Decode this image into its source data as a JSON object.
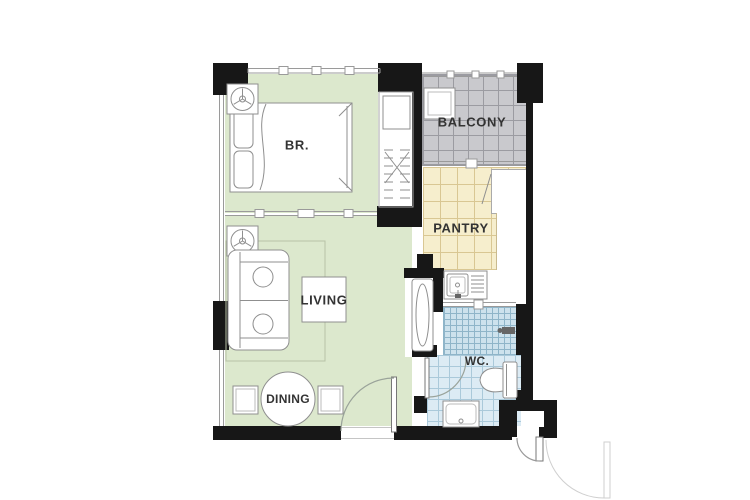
{
  "plan_title": "one-bedroom unit floor plan",
  "rooms": {
    "bedroom": {
      "label": "BR."
    },
    "balcony": {
      "label": "BALCONY"
    },
    "pantry": {
      "label": "PANTRY"
    },
    "living": {
      "label": "LIVING"
    },
    "dining": {
      "label": "DINING"
    },
    "wc": {
      "label": "WC."
    }
  },
  "colors": {
    "wall": "#171717",
    "bedroom_floor": "#dce8cd",
    "balcony_floor": "#c9c9cd",
    "balcony_grid": "#9b9ba1",
    "pantry_floor": "#f6eecd",
    "pantry_grid": "#d9c793",
    "shower_floor": "#cde2ed",
    "shower_grid": "#8fb5c9",
    "wc_floor": "#dcebf4",
    "wc_grid": "#aac9da",
    "furniture_line": "#8f8f8f",
    "label_text": "#333333"
  },
  "furniture": [
    "double-bed",
    "pillows",
    "wardrobe",
    "ac-unit-bedroom",
    "ac-unit-living",
    "balcony-condenser",
    "sofa",
    "coffee-table",
    "dining-table",
    "dining-chairs",
    "refrigerator",
    "kitchen-sink",
    "pantry-counter",
    "shower-head",
    "toilet",
    "washbasin",
    "swing-doors"
  ]
}
